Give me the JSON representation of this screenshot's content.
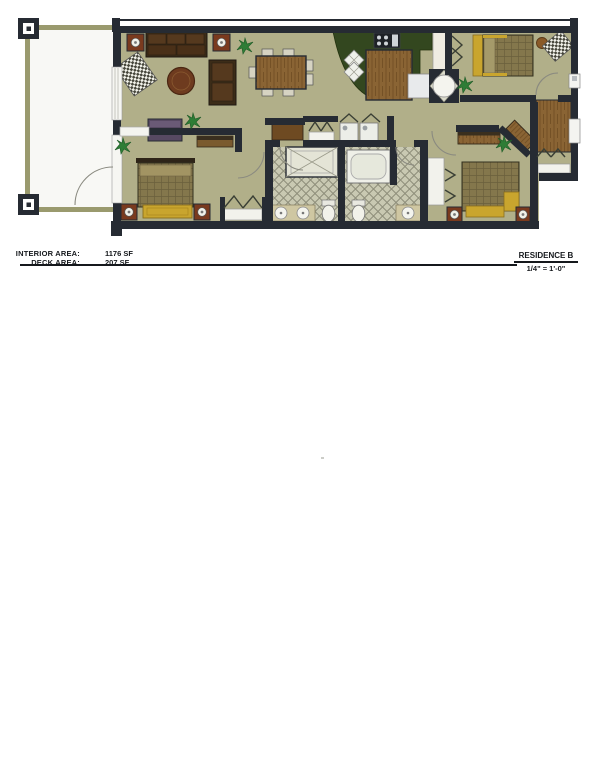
{
  "title_block": {
    "interior_area_label": "INTERIOR AREA:",
    "interior_area_value": "1176 SF",
    "deck_area_label": "DECK AREA:",
    "deck_area_value": "207 SF",
    "residence_name": "RESIDENCE B",
    "scale": "1/4\" = 1'-0\""
  },
  "plan_colors": {
    "wall": "#262b33",
    "interior_floor": "#b1af89",
    "deck_frame": "#9a9a6e",
    "deck_floor": "#f8f8f5",
    "bath_tile": "#c9c9b2",
    "kitchen_counter": "#33471f",
    "wood": "#8a6434",
    "sofa_brown": "#3c2c18",
    "accent_rust": "#7a3a1e",
    "accent_yellow": "#c9a52e",
    "bedspread": "#84774c",
    "dresser_purple": "#574962",
    "plant_green": "#2e7d36",
    "fixture_white": "#f2f2ea"
  }
}
